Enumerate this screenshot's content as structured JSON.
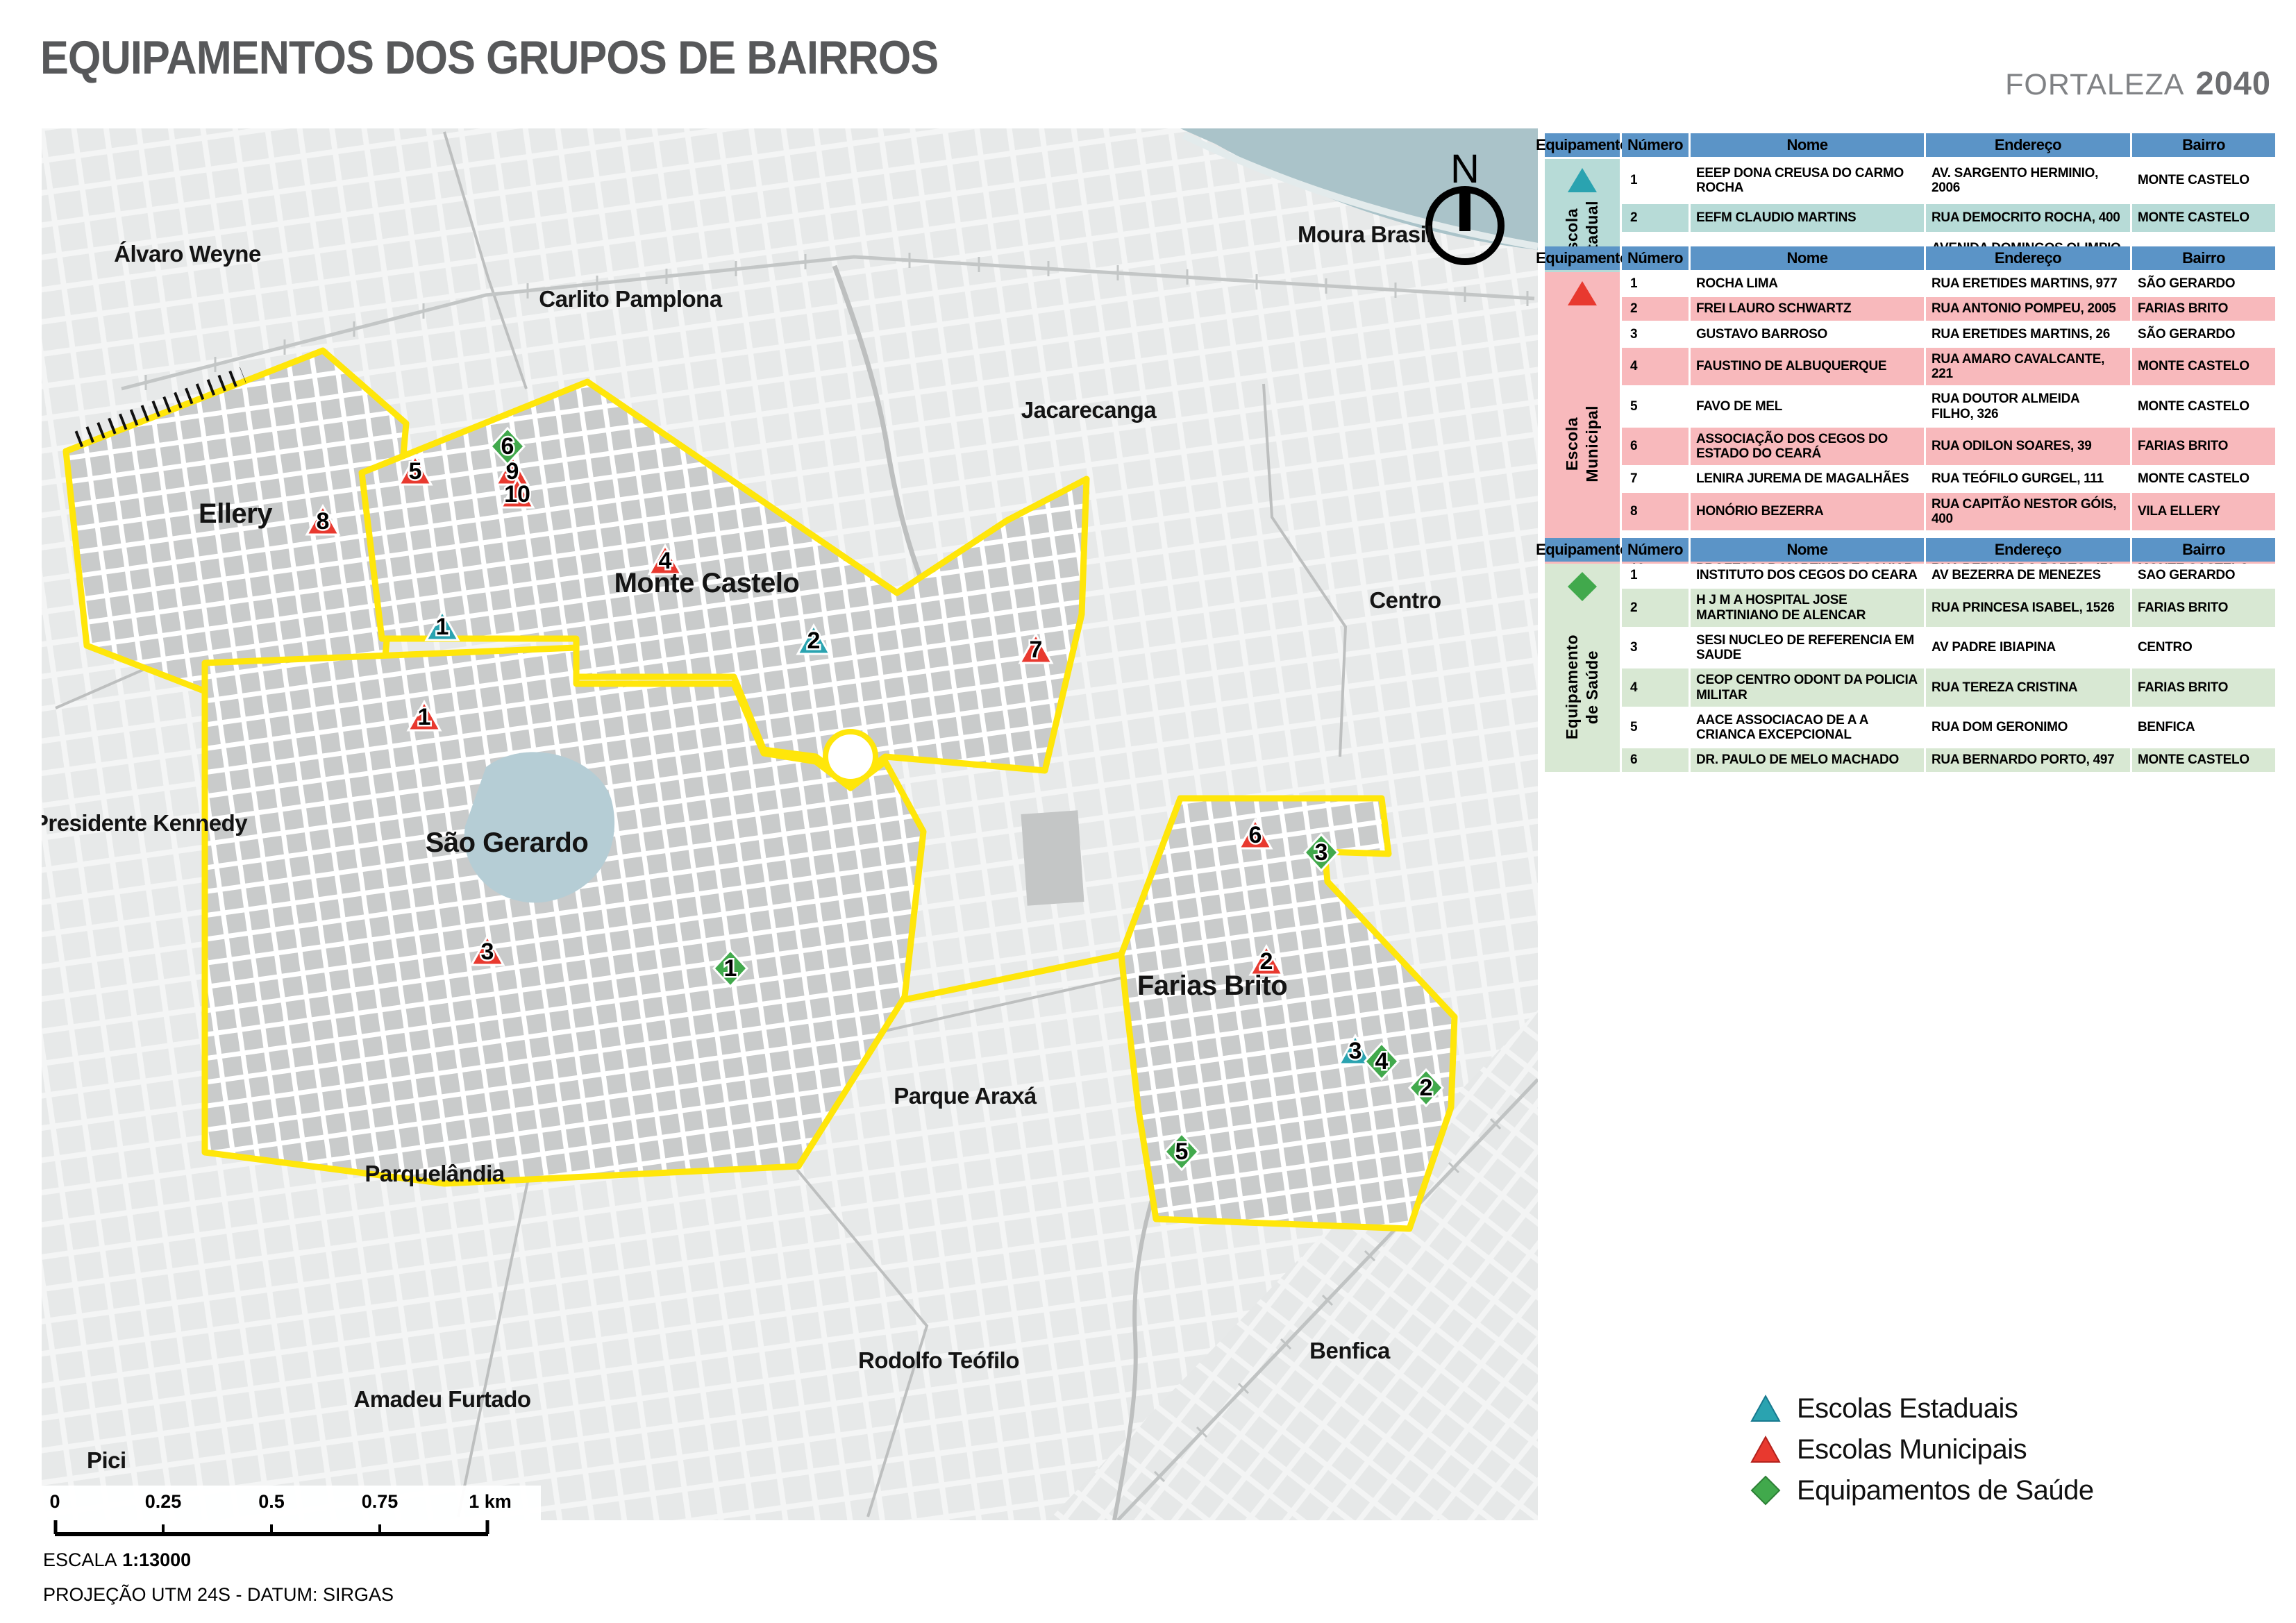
{
  "title": "EQUIPAMENTOS DOS GRUPOS DE BAIRROS",
  "brand": {
    "city": "FORTALEZA",
    "year": "2040"
  },
  "compass_label": "N",
  "colors": {
    "estadual": "#2aa3b0",
    "municipal": "#e8392f",
    "saude": "#41a94c",
    "group_boundary": "#ffe60a",
    "table_header": "#5b94c7",
    "estadual_tint": "#b7dbd7",
    "municipal_tint": "#f8b9bc",
    "saude_tint": "#d8e8d3",
    "water": "#aac3c9"
  },
  "map": {
    "labels": [
      {
        "text": "Álvaro Weyne"
      },
      {
        "text": "Carlito Pamplona"
      },
      {
        "text": "Moura Brasil"
      },
      {
        "text": "Jacarecanga"
      },
      {
        "text": "Centro"
      },
      {
        "text": "Ellery"
      },
      {
        "text": "Monte Castelo"
      },
      {
        "text": "São Gerardo"
      },
      {
        "text": "Farias Brito"
      },
      {
        "text": "Presidente Kennedy"
      },
      {
        "text": "Parque Araxá"
      },
      {
        "text": "Parquelândia"
      },
      {
        "text": "Rodolfo Teófilo"
      },
      {
        "text": "Amadeu Furtado"
      },
      {
        "text": "Benfica"
      },
      {
        "text": "Pici"
      }
    ],
    "markers": [
      {
        "type": "estadual",
        "number": "1"
      },
      {
        "type": "estadual",
        "number": "2"
      },
      {
        "type": "estadual",
        "number": "3"
      },
      {
        "type": "municipal",
        "number": "1"
      },
      {
        "type": "municipal",
        "number": "2"
      },
      {
        "type": "municipal",
        "number": "3"
      },
      {
        "type": "municipal",
        "number": "4"
      },
      {
        "type": "municipal",
        "number": "5"
      },
      {
        "type": "municipal",
        "number": "6"
      },
      {
        "type": "municipal",
        "number": "7"
      },
      {
        "type": "municipal",
        "number": "8"
      },
      {
        "type": "municipal",
        "number": "9"
      },
      {
        "type": "municipal",
        "number": "10"
      },
      {
        "type": "saude",
        "number": "1"
      },
      {
        "type": "saude",
        "number": "2"
      },
      {
        "type": "saude",
        "number": "3"
      },
      {
        "type": "saude",
        "number": "4"
      },
      {
        "type": "saude",
        "number": "5"
      },
      {
        "type": "saude",
        "number": "6"
      }
    ]
  },
  "tables": {
    "headers": [
      "Equipamento",
      "Número",
      "Nome",
      "Endereço",
      "Bairro"
    ],
    "estadual": {
      "group_label_1": "Escola",
      "group_label_2": "Estadual",
      "rows": [
        {
          "num": "1",
          "nome": "EEEP DONA CREUSA DO CARMO ROCHA",
          "endereco": "AV. SARGENTO HERMINIO, 2006",
          "bairro": "MONTE CASTELO"
        },
        {
          "num": "2",
          "nome": "EEFM CLAUDIO MARTINS",
          "endereco": "RUA DEMOCRITO ROCHA, 400",
          "bairro": "MONTE CASTELO"
        },
        {
          "num": "3",
          "nome": "EEFM DOUTOR CESAR CALS",
          "endereco": "AVENIDA DOMINGOS OLIMPIO, 1800",
          "bairro": "FARIAS BRITO"
        }
      ]
    },
    "municipal": {
      "group_label_1": "Escola",
      "group_label_2": "Municipal",
      "rows": [
        {
          "num": "1",
          "nome": "ROCHA LIMA",
          "endereco": "RUA ERETIDES MARTINS, 977",
          "bairro": "SÃO GERARDO"
        },
        {
          "num": "2",
          "nome": "FREI LAURO SCHWARTZ",
          "endereco": "RUA ANTONIO POMPEU, 2005",
          "bairro": "FARIAS BRITO"
        },
        {
          "num": "3",
          "nome": "GUSTAVO BARROSO",
          "endereco": "RUA ERETIDES MARTINS, 26",
          "bairro": "SÃO GERARDO"
        },
        {
          "num": "4",
          "nome": "FAUSTINO DE ALBUQUERQUE",
          "endereco": "RUA AMARO CAVALCANTE, 221",
          "bairro": "MONTE CASTELO"
        },
        {
          "num": "5",
          "nome": "FAVO DE MEL",
          "endereco": "RUA DOUTOR ALMEIDA FILHO, 326",
          "bairro": "MONTE CASTELO"
        },
        {
          "num": "6",
          "nome": "ASSOCIAÇÃO DOS CEGOS DO ESTADO DO CEARÁ",
          "endereco": "RUA ODILON SOARES, 39",
          "bairro": "FARIAS BRITO"
        },
        {
          "num": "7",
          "nome": "LENIRA JUREMA DE MAGALHÃES",
          "endereco": "RUA TEÓFILO GURGEL, 111",
          "bairro": "MONTE CASTELO"
        },
        {
          "num": "8",
          "nome": "HONÓRIO BEZERRA",
          "endereco": "RUA CAPITÃO NESTOR GÓIS, 400",
          "bairro": "VILA ELLERY"
        },
        {
          "num": "9",
          "nome": "PROFESSOR MARTINZ DE AGUIAR",
          "endereco": "RUA BERNARDO PORTO, 470",
          "bairro": "MONTE CASTELO"
        },
        {
          "num": "10",
          "nome": "PROFESSOR MARTINZ DE AGUIAR",
          "endereco": "RUA BERNARDO PORTO, 470",
          "bairro": "MONTE CASTELO"
        }
      ]
    },
    "saude": {
      "group_label_1": "Equipamento",
      "group_label_2": "de Saúde",
      "rows": [
        {
          "num": "1",
          "nome": "INSTITUTO DOS CEGOS DO CEARA",
          "endereco": "AV BEZERRA DE MENEZES",
          "bairro": "SAO GERARDO"
        },
        {
          "num": "2",
          "nome": "H J M A HOSPITAL JOSE MARTINIANO DE ALENCAR",
          "endereco": "RUA PRINCESA ISABEL, 1526",
          "bairro": "FARIAS BRITO"
        },
        {
          "num": "3",
          "nome": "SESI NUCLEO DE REFERENCIA EM SAUDE",
          "endereco": "AV PADRE IBIAPINA",
          "bairro": "CENTRO"
        },
        {
          "num": "4",
          "nome": "CEOP CENTRO ODONT DA POLICIA MILITAR",
          "endereco": "RUA TEREZA CRISTINA",
          "bairro": "FARIAS BRITO"
        },
        {
          "num": "5",
          "nome": "AACE ASSOCIACAO DE A A CRIANCA EXCEPCIONAL",
          "endereco": "RUA DOM GERONIMO",
          "bairro": "BENFICA"
        },
        {
          "num": "6",
          "nome": "DR. PAULO DE MELO MACHADO",
          "endereco": "RUA BERNARDO PORTO, 497",
          "bairro": "MONTE CASTELO"
        }
      ]
    }
  },
  "legend": {
    "items": [
      {
        "label": "Escolas Estaduais"
      },
      {
        "label": "Escolas Municipais"
      },
      {
        "label": "Equipamentos de Saúde"
      }
    ]
  },
  "scalebar": {
    "ticks": [
      "0",
      "0.25",
      "0.5",
      "0.75",
      "1 km"
    ],
    "escala_label": "ESCALA",
    "escala_value": "1:13000",
    "projection": "PROJEÇÃO UTM 24S - DATUM: SIRGAS"
  }
}
